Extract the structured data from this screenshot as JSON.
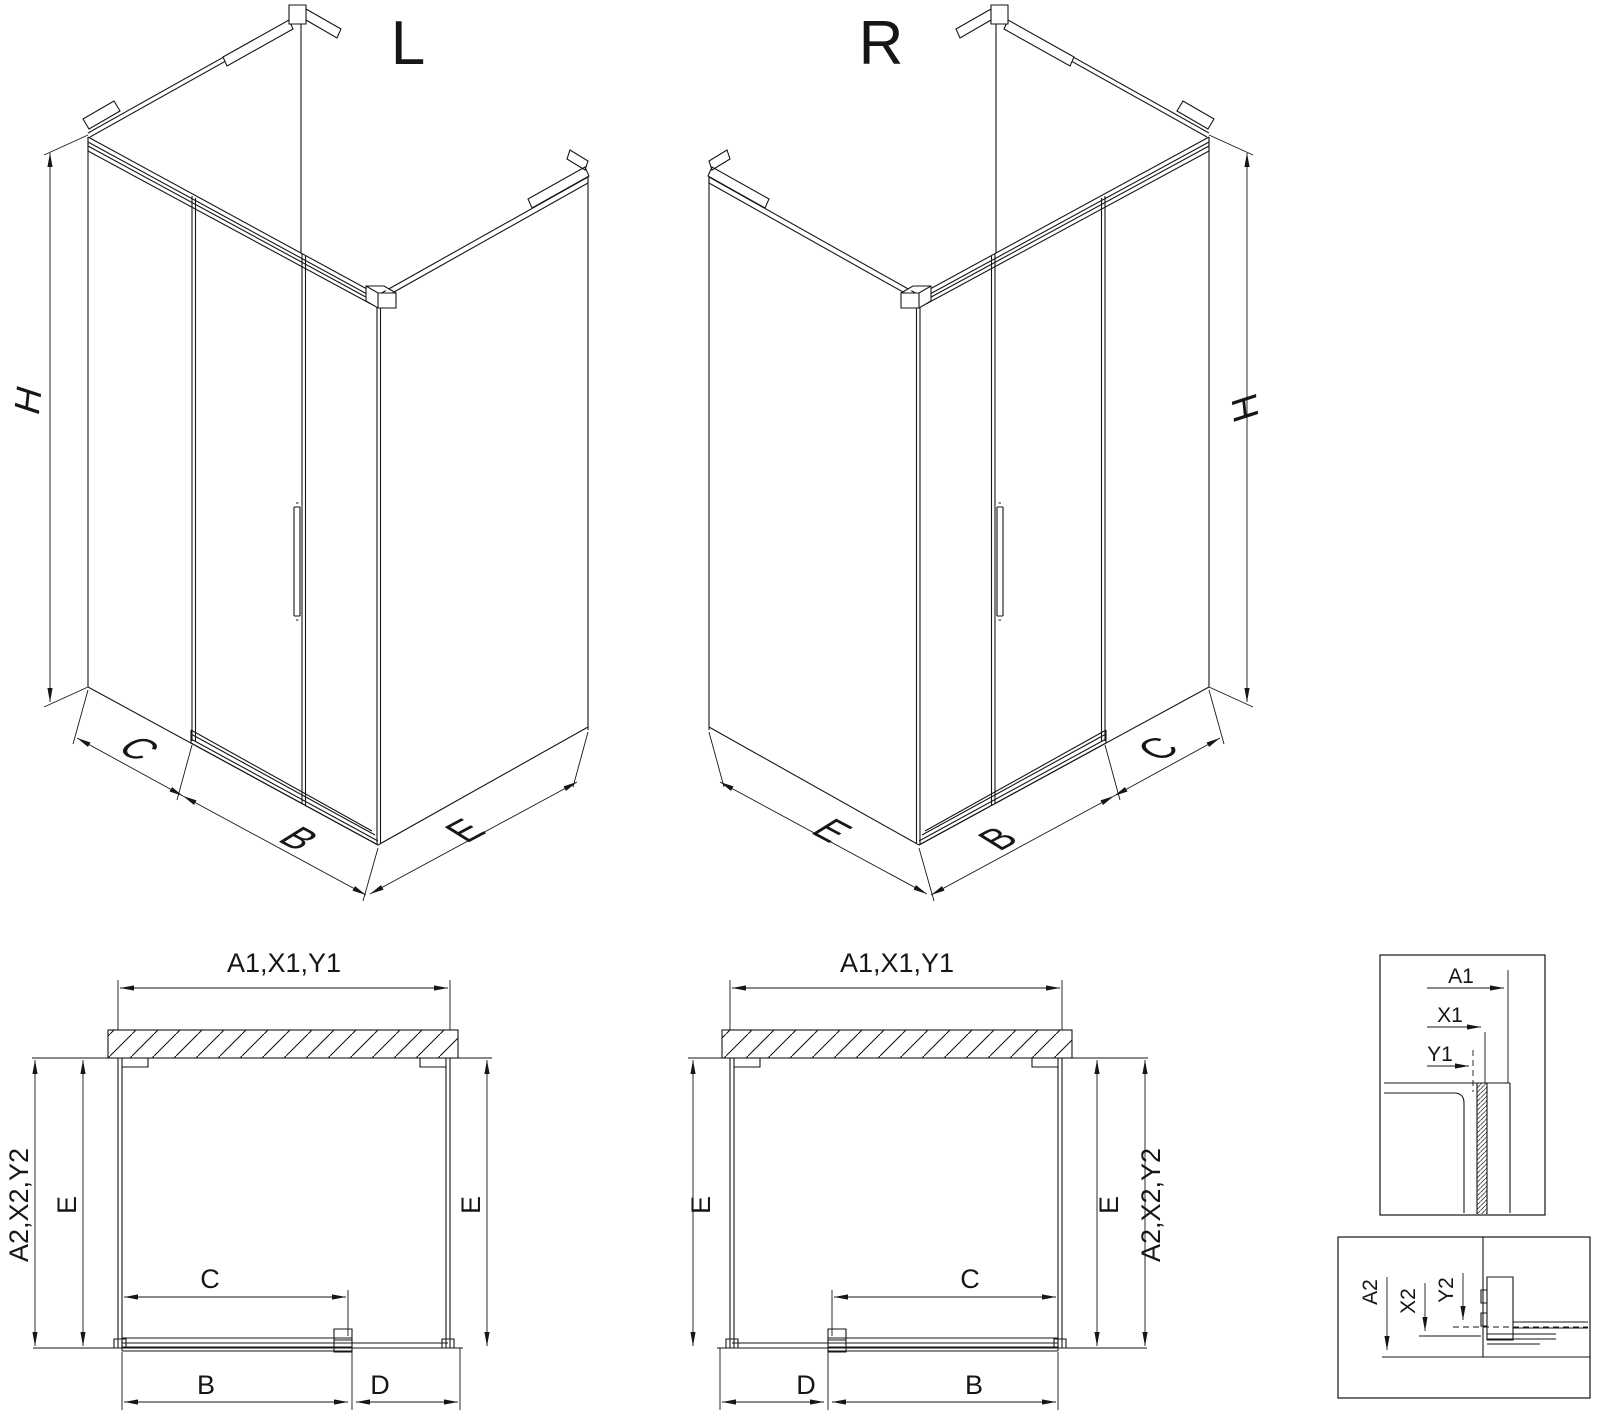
{
  "drawing": {
    "iso": {
      "left_title": "L",
      "right_title": "R",
      "height_label": "H",
      "fixed_width_label": "C",
      "door_width_label": "B",
      "depth_label": "E"
    },
    "plan": {
      "top_label": "A1,X1,Y1",
      "side_label": "A2,X2,Y2",
      "depth_label": "E",
      "opening_label": "C",
      "door_label": "B",
      "fixed_label": "D"
    },
    "detail_top": {
      "a1": "A1",
      "x1": "X1",
      "y1": "Y1"
    },
    "detail_bottom": {
      "a2": "A2",
      "x2": "X2",
      "y2": "Y2"
    }
  }
}
